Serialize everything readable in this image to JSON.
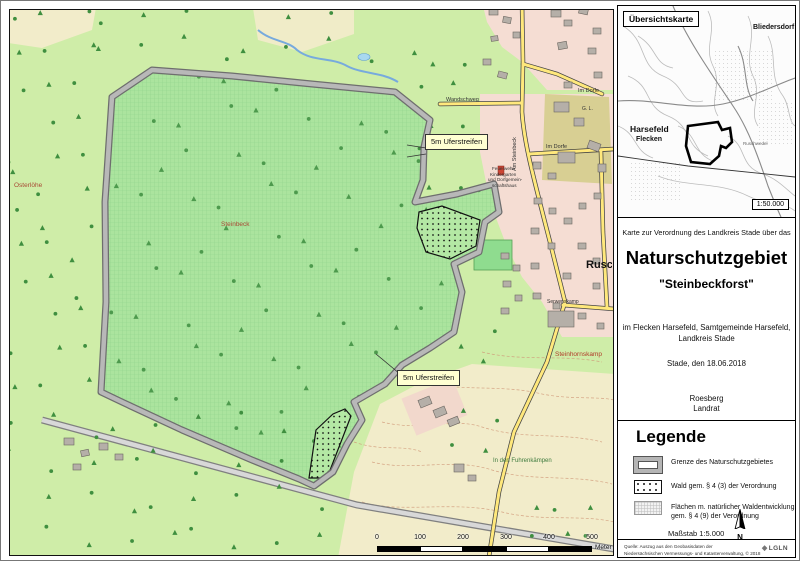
{
  "overview": {
    "label": "Übersichtskarte",
    "scale": "1:50.000",
    "places": [
      {
        "text": "Bliedersdorf",
        "x": 752,
        "y": 23,
        "size": 7,
        "bold": true
      },
      {
        "text": "Harsefeld",
        "x": 629,
        "y": 124,
        "size": 8.5,
        "bold": true
      },
      {
        "text": "Flecken",
        "x": 635,
        "y": 135,
        "size": 7,
        "bold": true
      },
      {
        "text": "Ruschwedel",
        "x": 742,
        "y": 141,
        "size": 4.5,
        "color": "#666"
      }
    ]
  },
  "title_panel": {
    "intro": "Karte zur Verordnung des Landkreis Stade über das",
    "title": "Naturschutzgebiet",
    "subtitle": "\"Steinbeckforst\"",
    "location1": "im Flecken Harsefeld, Samtgemeinde Harsefeld,",
    "location2": "Landkreis Stade",
    "date": "Stade, den 18.06.2018",
    "signature_name": "Roesberg",
    "signature_title": "Landrat"
  },
  "legend": {
    "heading": "Legende",
    "items": [
      {
        "id": "boundary",
        "label": "Grenze des Naturschutzgebietes"
      },
      {
        "id": "wald",
        "label": "Wald gem. § 4 (3) der Verordnung"
      },
      {
        "id": "entwicklung",
        "label": "Flächen m. natürlicher Waldentwicklung\ngem. § 4 (9) der Verordnung"
      }
    ],
    "scale_label": "Maßstab 1:5.000",
    "north_label": "N"
  },
  "footer": {
    "line1": "Quelle: Auszug aus den Geobasisdaten der",
    "line2": "Niedersächsischen Vermessungs- und Katasterverwaltung, © 2018",
    "logo": "LGLN"
  },
  "map": {
    "labels": [
      {
        "text": "Osterlöhe",
        "x": 13,
        "y": 182,
        "size": 6.5,
        "color": "#a84a35"
      },
      {
        "text": "Steinbeck",
        "x": 220,
        "y": 221,
        "size": 6.5,
        "color": "#a84a35"
      },
      {
        "text": "Steinhornskamp",
        "x": 554,
        "y": 351,
        "size": 6.5,
        "color": "#b03a28"
      },
      {
        "text": "Rusch",
        "x": 585,
        "y": 259,
        "size": 11,
        "bold": true,
        "color": "#111"
      },
      {
        "text": "Wandschweg",
        "x": 445,
        "y": 97,
        "size": 5.5,
        "color": "#333"
      },
      {
        "text": "Im Dorfe",
        "x": 545,
        "y": 144,
        "size": 5.5,
        "color": "#333"
      },
      {
        "text": "Im Dorfe",
        "x": 577,
        "y": 88,
        "size": 5.5,
        "color": "#333"
      },
      {
        "text": "G. L.",
        "x": 581,
        "y": 106,
        "size": 5,
        "color": "#333"
      },
      {
        "text": "Am Steinbeck",
        "x": 512,
        "y": 170,
        "size": 5.5,
        "color": "#333",
        "rotate": -90
      },
      {
        "text": "Serwenskamp",
        "x": 546,
        "y": 299,
        "size": 5,
        "color": "#333"
      },
      {
        "text": "In den Fuhrenkämpen",
        "x": 492,
        "y": 457,
        "size": 6,
        "color": "#3d7a3d"
      },
      {
        "text": "Feuerwehr-",
        "x": 491,
        "y": 166,
        "size": 4.6,
        "color": "#333"
      },
      {
        "text": "Kindergarten",
        "x": 489,
        "y": 171.5,
        "size": 4.6,
        "color": "#333"
      },
      {
        "text": "und Dorfgemein-",
        "x": 487,
        "y": 177,
        "size": 4.6,
        "color": "#333"
      },
      {
        "text": "schaftshaus",
        "x": 491,
        "y": 182.5,
        "size": 4.6,
        "color": "#333"
      }
    ],
    "callouts": [
      {
        "text": "5m Uferstreifen",
        "x": 424,
        "y": 133
      },
      {
        "text": "5m Uferstreifen",
        "x": 396,
        "y": 369
      }
    ],
    "scalebar": {
      "ticks": [
        "0",
        "100",
        "200",
        "300",
        "400",
        "500"
      ],
      "unit": "Meter"
    }
  },
  "colors": {
    "reserve_green": "#abe49e",
    "base_green": "#cfeda8",
    "boundary_gray": "#b8b8b8",
    "road_yellow": "#ffe87c",
    "water_blue": "#a8d8f0",
    "field_beige": "#f2ecca",
    "residential_pink": "#f5ddd3"
  }
}
